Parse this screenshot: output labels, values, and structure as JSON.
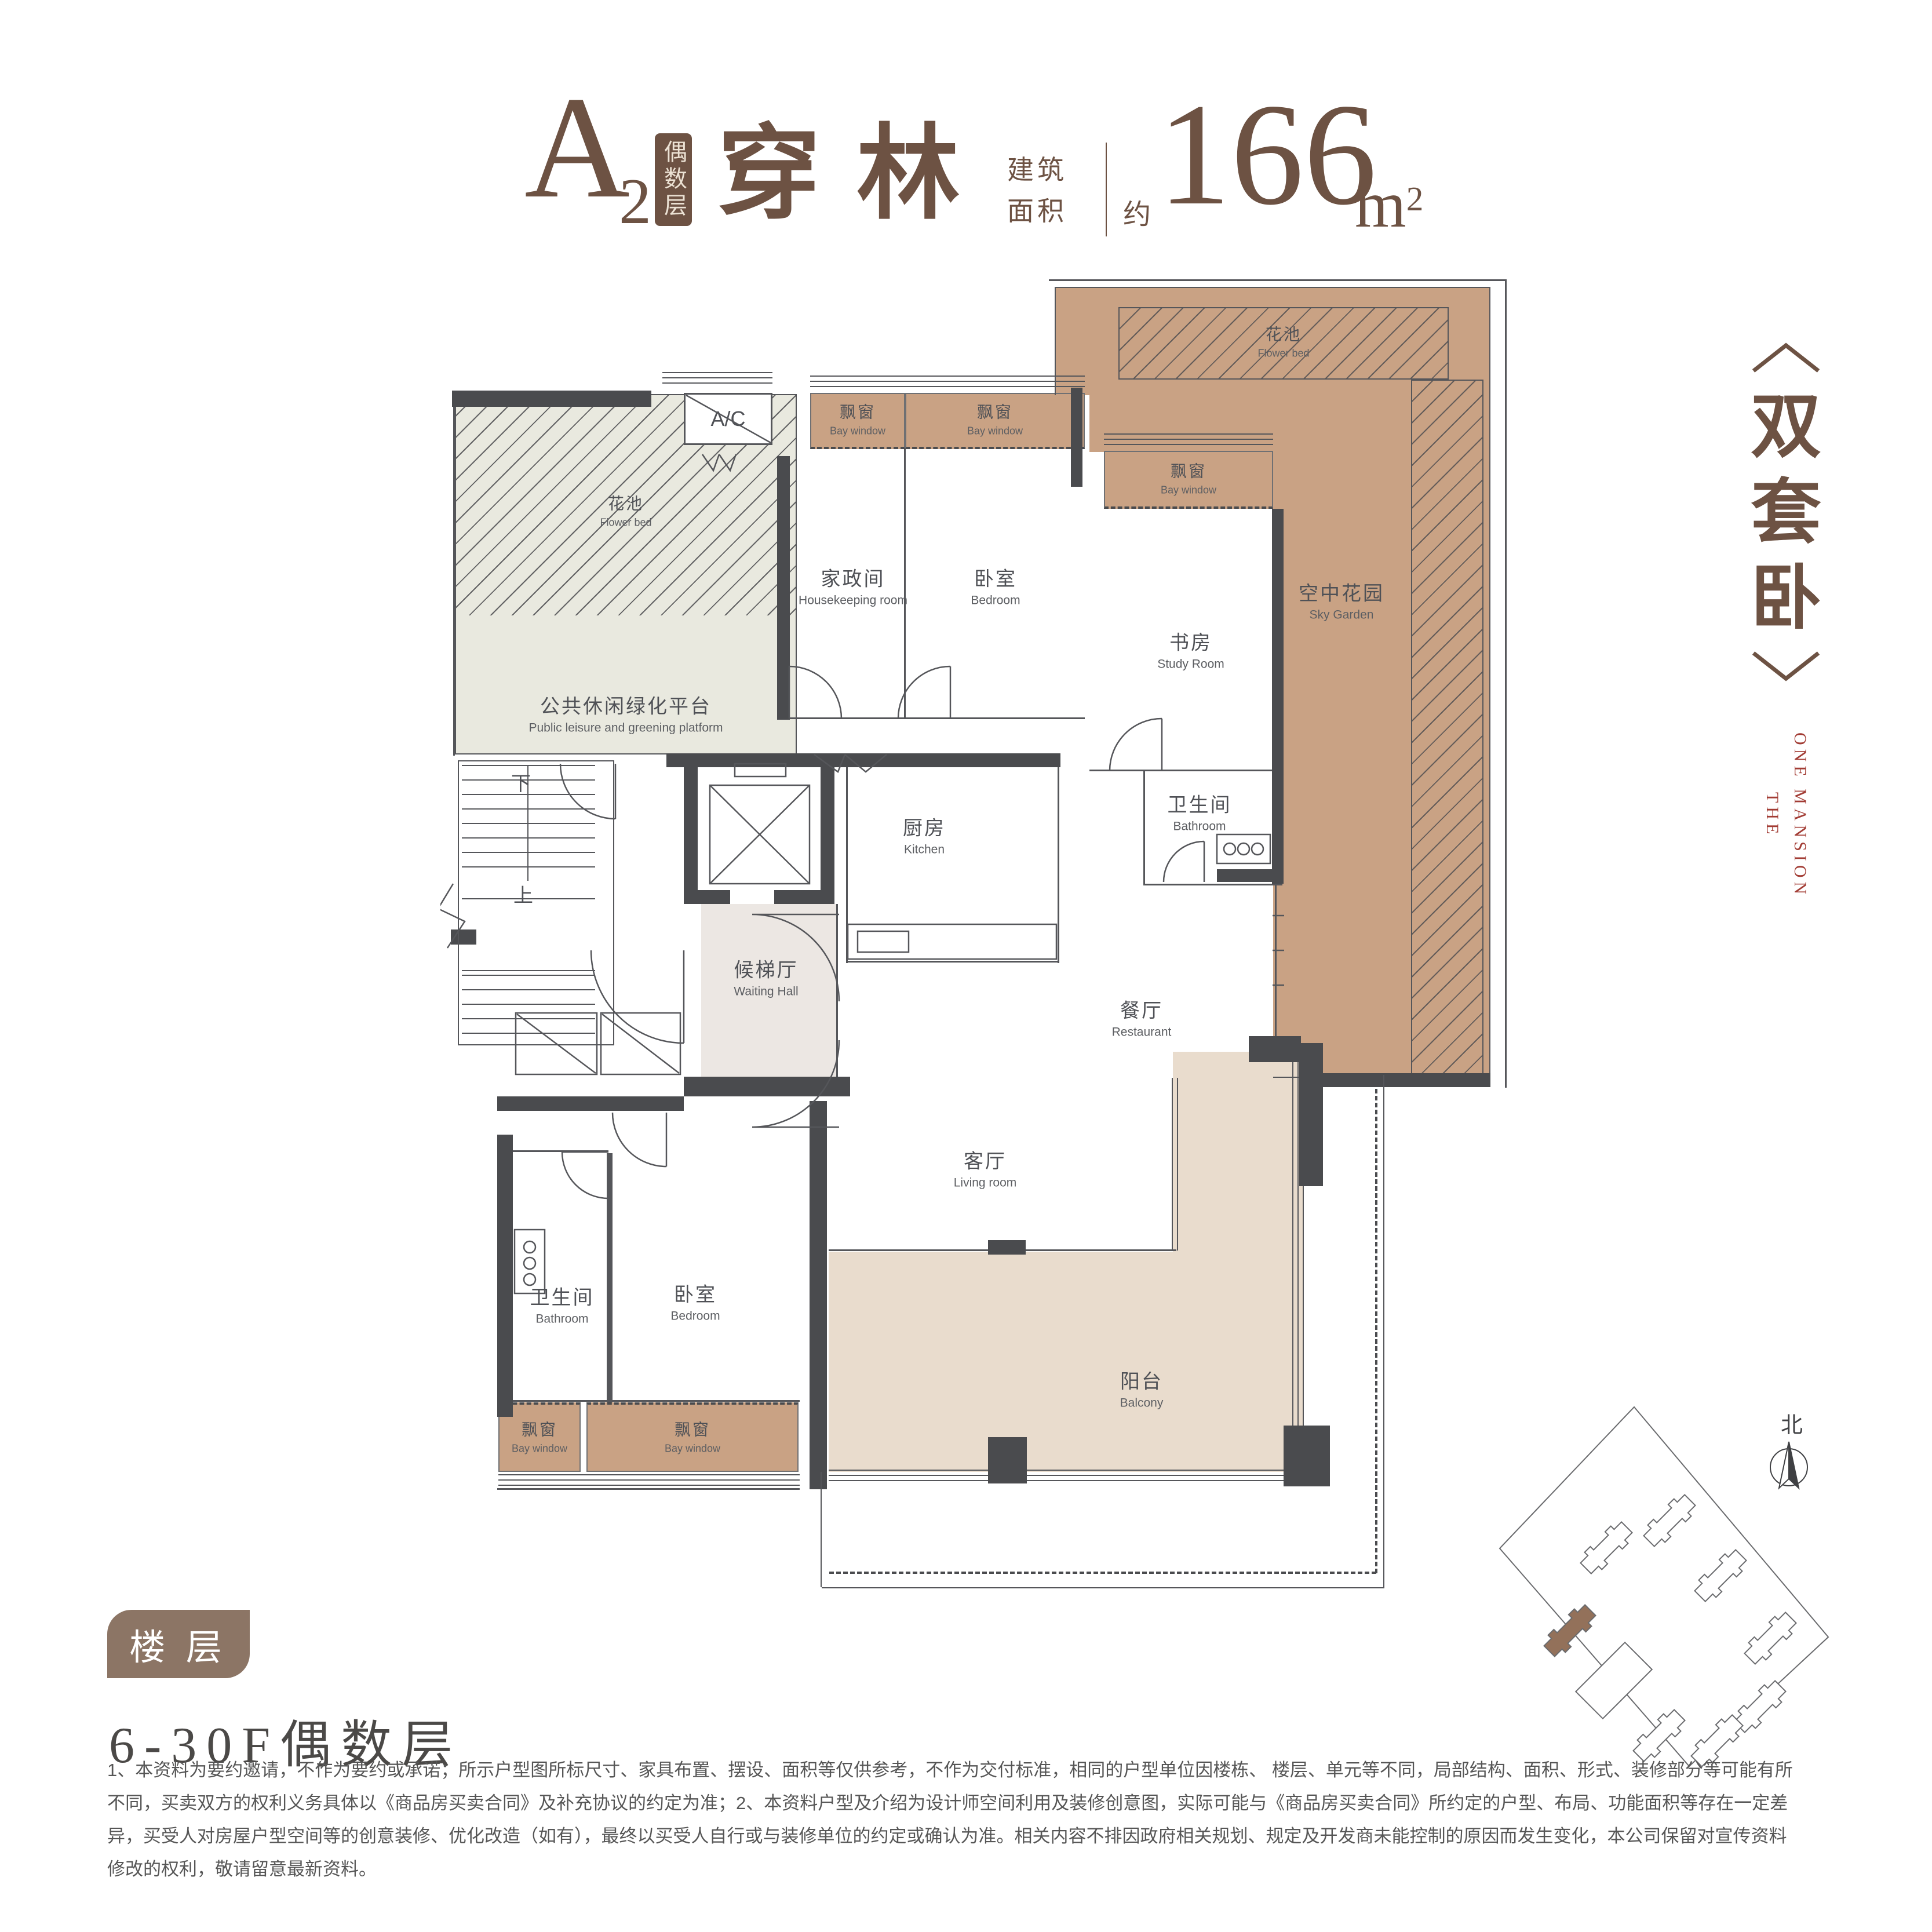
{
  "header": {
    "unit": "A",
    "unit_sub": "2",
    "badge": "偶数层",
    "name": "穿林",
    "area_label_line1": "建筑",
    "area_label_line2": "面积",
    "approx": "约",
    "area_value": "166",
    "area_unit": "m",
    "area_sup": "2"
  },
  "tagline": {
    "chars": {
      "c1": "双",
      "c2": "套",
      "c3": "卧"
    },
    "brand_line1": "THE",
    "brand_line2": "ONE MANSION"
  },
  "plan": {
    "bay_window": {
      "cn": "飘窗",
      "en": "Bay window"
    },
    "ac_label": "A/C",
    "stairs_down": "下",
    "stairs_up": "上",
    "rooms": {
      "flower_bed_left": {
        "cn": "花池",
        "en": "Flower bed"
      },
      "platform": {
        "cn": "公共休闲绿化平台",
        "en": "Public leisure and greening platform"
      },
      "housekeeping": {
        "cn": "家政间",
        "en": "Housekeeping room"
      },
      "bedroom_top": {
        "cn": "卧室",
        "en": "Bedroom"
      },
      "study": {
        "cn": "书房",
        "en": "Study Room"
      },
      "bathroom_top": {
        "cn": "卫生间",
        "en": "Bathroom"
      },
      "flower_bed_sky": {
        "cn": "花池",
        "en": "Flower bed"
      },
      "sky_garden": {
        "cn": "空中花园",
        "en": "Sky Garden"
      },
      "kitchen": {
        "cn": "厨房",
        "en": "Kitchen"
      },
      "waiting_hall": {
        "cn": "候梯厅",
        "en": "Waiting Hall"
      },
      "restaurant": {
        "cn": "餐厅",
        "en": "Restaurant"
      },
      "living": {
        "cn": "客厅",
        "en": "Living room"
      },
      "bathroom_low": {
        "cn": "卫生间",
        "en": "Bathroom"
      },
      "bedroom_low": {
        "cn": "卧室",
        "en": "Bedroom"
      },
      "balcony": {
        "cn": "阳台",
        "en": "Balcony"
      }
    }
  },
  "floor": {
    "badge": "楼 层",
    "range": "6-30F偶数层"
  },
  "siteplan": {
    "north_label": "北"
  },
  "disclaimer": {
    "line1": "1、本资料为要约邀请，不作为要约或承诺；所示户型图所标尺寸、家具布置、摆设、面积等仅供参考，不作为交付标准，相同的户型单位因楼栋、 楼层、单元等不同，局部结构、面积、形式、装修部分等可能有所",
    "line2": "不同，买卖双方的权利义务具体以《商品房买卖合同》及补充协议的约定为准；2、本资料户型及介绍为设计师空间利用及装修创意图，实际可能与《商品房买卖合同》所约定的户型、布局、功能面积等存在一定差",
    "line3": "异，买受人对房屋户型空间等的创意装修、优化改造（如有），最终以买受人自行或与装修单位的约定或确认为准。相关内容不排因政府相关规划、规定及开发商未能控制的原因而发生变化，本公司保留对宣传资料",
    "line4": "修改的权利，敬请留意最新资料。"
  },
  "colors": {
    "brown": "#6d5243",
    "badge-brown": "#8c7565",
    "bay": "#c9a284",
    "greenfill": "#e9e9df",
    "wall": "#4a4b4e",
    "line": "#55565a",
    "hall": "#ece7e3",
    "balc": "#e9dccd",
    "red": "#a23c34",
    "gray": "#565656",
    "label": "#4f5156"
  }
}
